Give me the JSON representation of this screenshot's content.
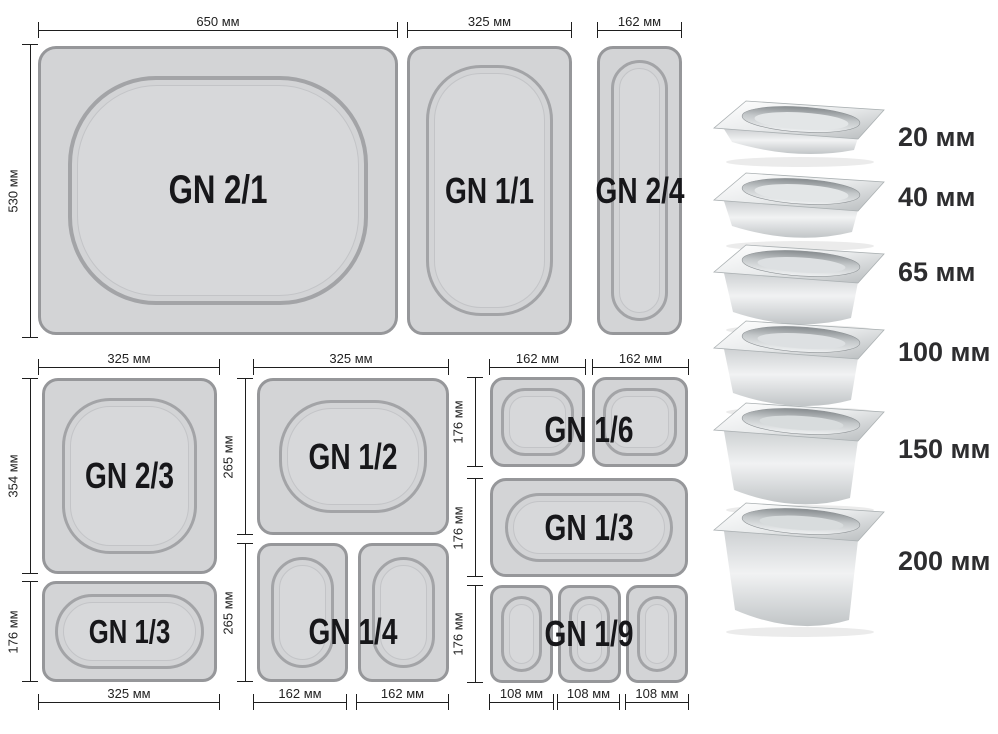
{
  "colors": {
    "tray_fill": "#d3d4d6",
    "tray_border": "#96979a",
    "dimension_line": "#1e1e1e",
    "label_text": "#17171a"
  },
  "trays": {
    "gn_2_1": "GN 2/1",
    "gn_1_1": "GN 1/1",
    "gn_2_4": "GN 2/4",
    "gn_2_3": "GN 2/3",
    "gn_1_3_left": "GN 1/3",
    "gn_1_2": "GN 1/2",
    "gn_1_4": "GN 1/4",
    "gn_1_6": "GN 1/6",
    "gn_1_3_right": "GN 1/3",
    "gn_1_9": "GN 1/9"
  },
  "dimensions": {
    "w650": "650 мм",
    "h530": "530 мм",
    "w325": "325 мм",
    "w162": "162 мм",
    "h354": "354 мм",
    "h176": "176 мм",
    "h265": "265 мм",
    "w108": "108 мм"
  },
  "depth_legend": [
    {
      "depth": "20 мм"
    },
    {
      "depth": "40 мм"
    },
    {
      "depth": "65 мм"
    },
    {
      "depth": "100 мм"
    },
    {
      "depth": "150 мм"
    },
    {
      "depth": "200 мм"
    }
  ]
}
